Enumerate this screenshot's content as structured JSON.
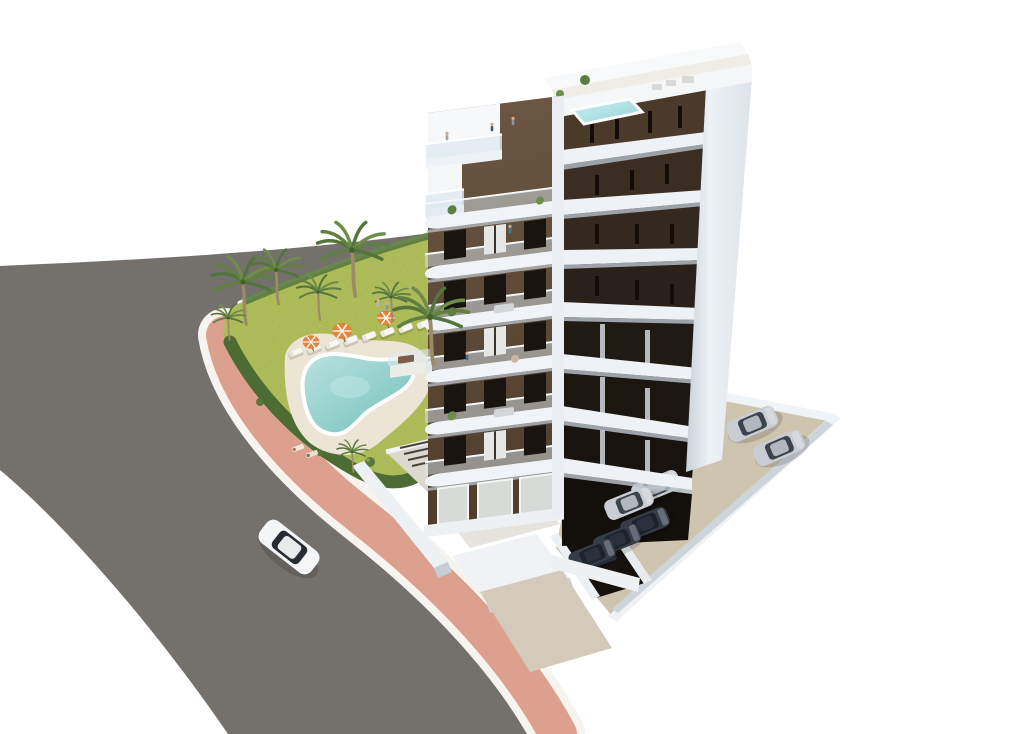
{
  "image": {
    "description": "Aerial 3D architectural rendering of a modern 8-storey apartment tower in white and dark brown with curved white balconies and a rooftop plunge pool, a landscaped garden with free-form turquoise swimming pool, sun loungers, striped parasols and palm trees, a curved grey asphalt road with pink pavement, and a private parking area with cars.",
    "width": 1020,
    "height": 734
  },
  "colors": {
    "background": "#ffffff",
    "road": "#6f6b67",
    "sidewalk": "#e2a18e",
    "sidewalk_edge": "#f7f4ef",
    "lawn": "#aab84e",
    "hedge": "#4d6c33",
    "pool_water": "#8fcdc8",
    "pool_deck": "#ece4d4",
    "facade_brown": "#5d4a37",
    "facade_dark": "#2e2620",
    "facade_white": "#eef1f5",
    "roof_pool": "#b5e2e6",
    "parking_floor": "#d3c9b2",
    "car_silver": "#c9cdd3",
    "car_dark": "#343c48",
    "car_white": "#f4f5f7",
    "palm_green": "#5e7d40"
  },
  "scene": {
    "building": {
      "storeys": 8,
      "style": "modern white concrete with dark brown panels and curved white balconies",
      "rooftop": {
        "plunge_pool": true,
        "terrace_furniture": true,
        "plants": true
      },
      "underground_parking_entrance": true
    },
    "garden": {
      "pool": "free-form turquoise pool with white coping",
      "palms": [
        {
          "x": 243,
          "y": 282,
          "s": 1.05
        },
        {
          "x": 276,
          "y": 270,
          "s": 0.85
        },
        {
          "x": 318,
          "y": 292,
          "s": 0.7
        },
        {
          "x": 352,
          "y": 250,
          "s": 1.15
        },
        {
          "x": 391,
          "y": 297,
          "s": 0.6
        },
        {
          "x": 430,
          "y": 317,
          "s": 1.2
        },
        {
          "x": 352,
          "y": 452,
          "s": 0.5
        },
        {
          "x": 228,
          "y": 318,
          "s": 0.55
        }
      ],
      "loungers": {
        "count": 8,
        "from": [
          296,
          352
        ],
        "to": [
          424,
          324
        ],
        "angle": -21
      },
      "umbrellas": [
        {
          "x": 342,
          "y": 331,
          "s": 1.0,
          "color": "#e8833a"
        },
        {
          "x": 386,
          "y": 318,
          "s": 0.9,
          "color": "#e8833a"
        },
        {
          "x": 311,
          "y": 342,
          "s": 0.85,
          "color": "#e8833a"
        }
      ],
      "towels": 2
    },
    "vehicles": {
      "cars": [
        {
          "type": "white",
          "layer": "road",
          "x": 289,
          "y": 547,
          "angle": 38,
          "s": 1.25
        },
        {
          "type": "silver",
          "layer": "lot",
          "x": 752,
          "y": 424,
          "angle": -23,
          "s": 1
        },
        {
          "type": "silver",
          "layer": "lot",
          "x": 779,
          "y": 448,
          "angle": -23,
          "s": 1
        },
        {
          "type": "silver",
          "layer": "under",
          "x": 656,
          "y": 487,
          "angle": -22,
          "s": 0.95
        },
        {
          "type": "silver",
          "layer": "under",
          "x": 629,
          "y": 503,
          "angle": -22,
          "s": 0.95
        },
        {
          "type": "dark",
          "layer": "under",
          "x": 645,
          "y": 524,
          "angle": -22,
          "s": 0.95
        },
        {
          "type": "dark",
          "layer": "under",
          "x": 617,
          "y": 540,
          "angle": -22,
          "s": 0.92
        },
        {
          "type": "dark",
          "layer": "under",
          "x": 592,
          "y": 555,
          "angle": -22,
          "s": 0.9
        }
      ]
    },
    "people": [
      {
        "x": 492,
        "y": 131,
        "color": "#3a5a7a"
      },
      {
        "x": 513,
        "y": 125,
        "color": "#8a93a0"
      },
      {
        "x": 467,
        "y": 360,
        "color": "#3a6a9a"
      },
      {
        "x": 510,
        "y": 233,
        "color": "#4a7a9a"
      },
      {
        "x": 378,
        "y": 307,
        "color": "#b0b6bb"
      },
      {
        "x": 387,
        "y": 310,
        "color": "#8a93a0"
      },
      {
        "x": 447,
        "y": 140,
        "color": "#9aa5ad"
      }
    ]
  }
}
